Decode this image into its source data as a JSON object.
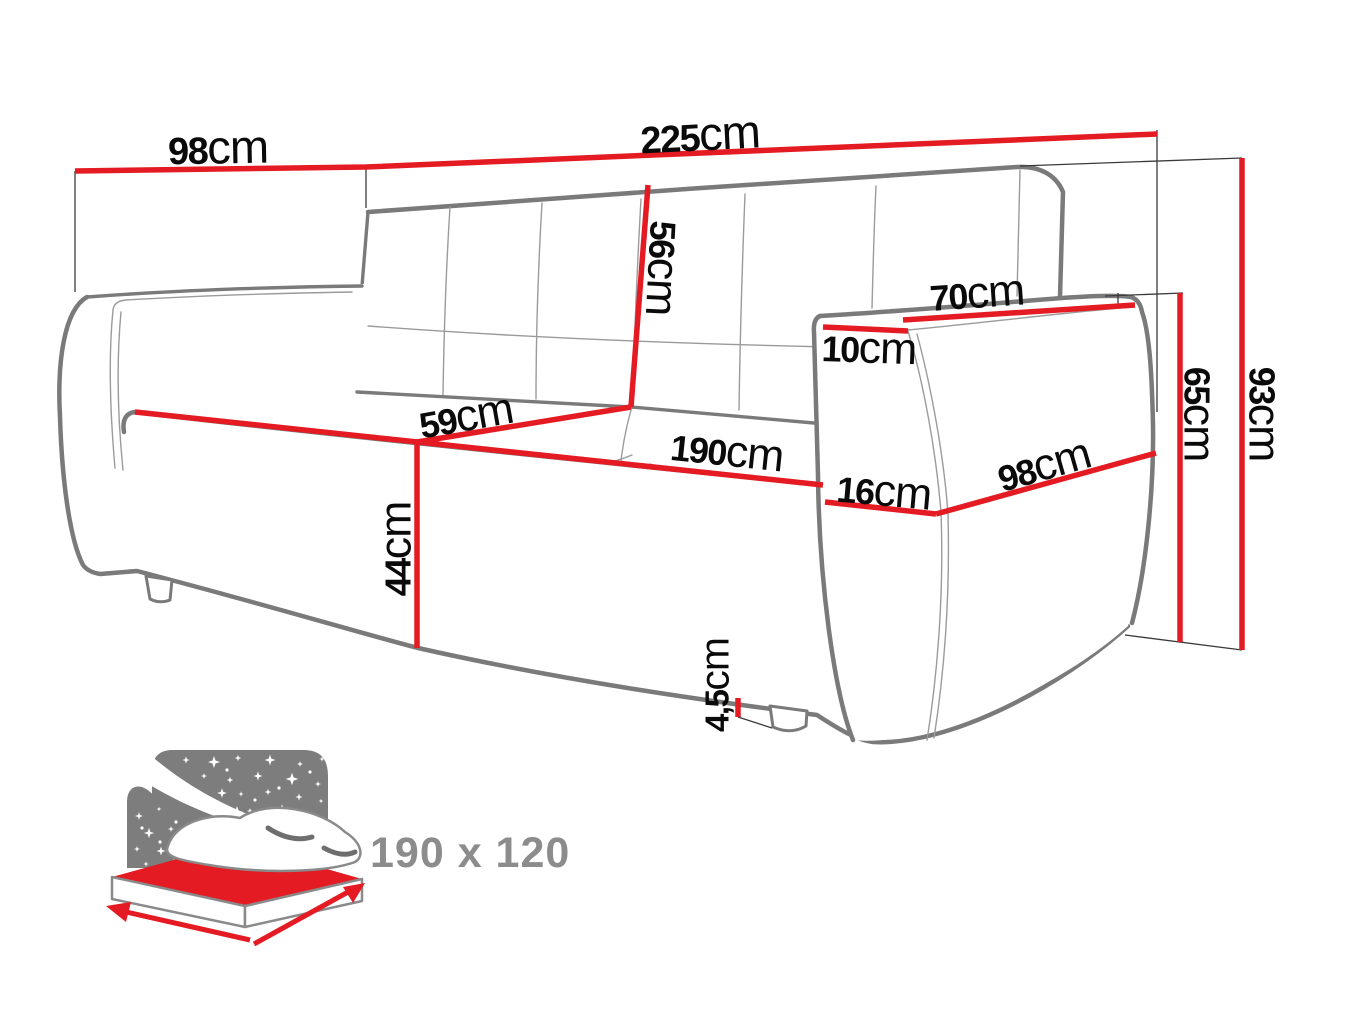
{
  "diagram_type": "sofa dimension drawing",
  "dims": {
    "depth_top": {
      "value": "98",
      "unit": "cm"
    },
    "total_width": {
      "value": "225",
      "unit": "cm"
    },
    "backrest_height": {
      "value": "56",
      "unit": "cm"
    },
    "seat_depth": {
      "value": "59",
      "unit": "cm"
    },
    "seat_width": {
      "value": "190",
      "unit": "cm"
    },
    "seat_height": {
      "value": "44",
      "unit": "cm"
    },
    "armrest_top_length": {
      "value": "70",
      "unit": "cm"
    },
    "armrest_top_width": {
      "value": "10",
      "unit": "cm"
    },
    "armrest_front_width": {
      "value": "16",
      "unit": "cm"
    },
    "armrest_side_depth": {
      "value": "98",
      "unit": "cm"
    },
    "armrest_height": {
      "value": "65",
      "unit": "cm"
    },
    "total_height": {
      "value": "93",
      "unit": "cm"
    },
    "leg_height": {
      "value": "4,5",
      "unit": "cm"
    }
  },
  "sleeping_icon": {
    "size_label": "190 x 120"
  },
  "colors": {
    "dimension_red": "#e41b22",
    "outline_gray": "#7a7a7a",
    "seam_gray": "#9b9b9b",
    "extension_black": "#3a3a3a",
    "label_black": "#0a0a0a",
    "icon_gray": "#7d7d7d",
    "icon_text_gray": "#8c8c8c"
  }
}
